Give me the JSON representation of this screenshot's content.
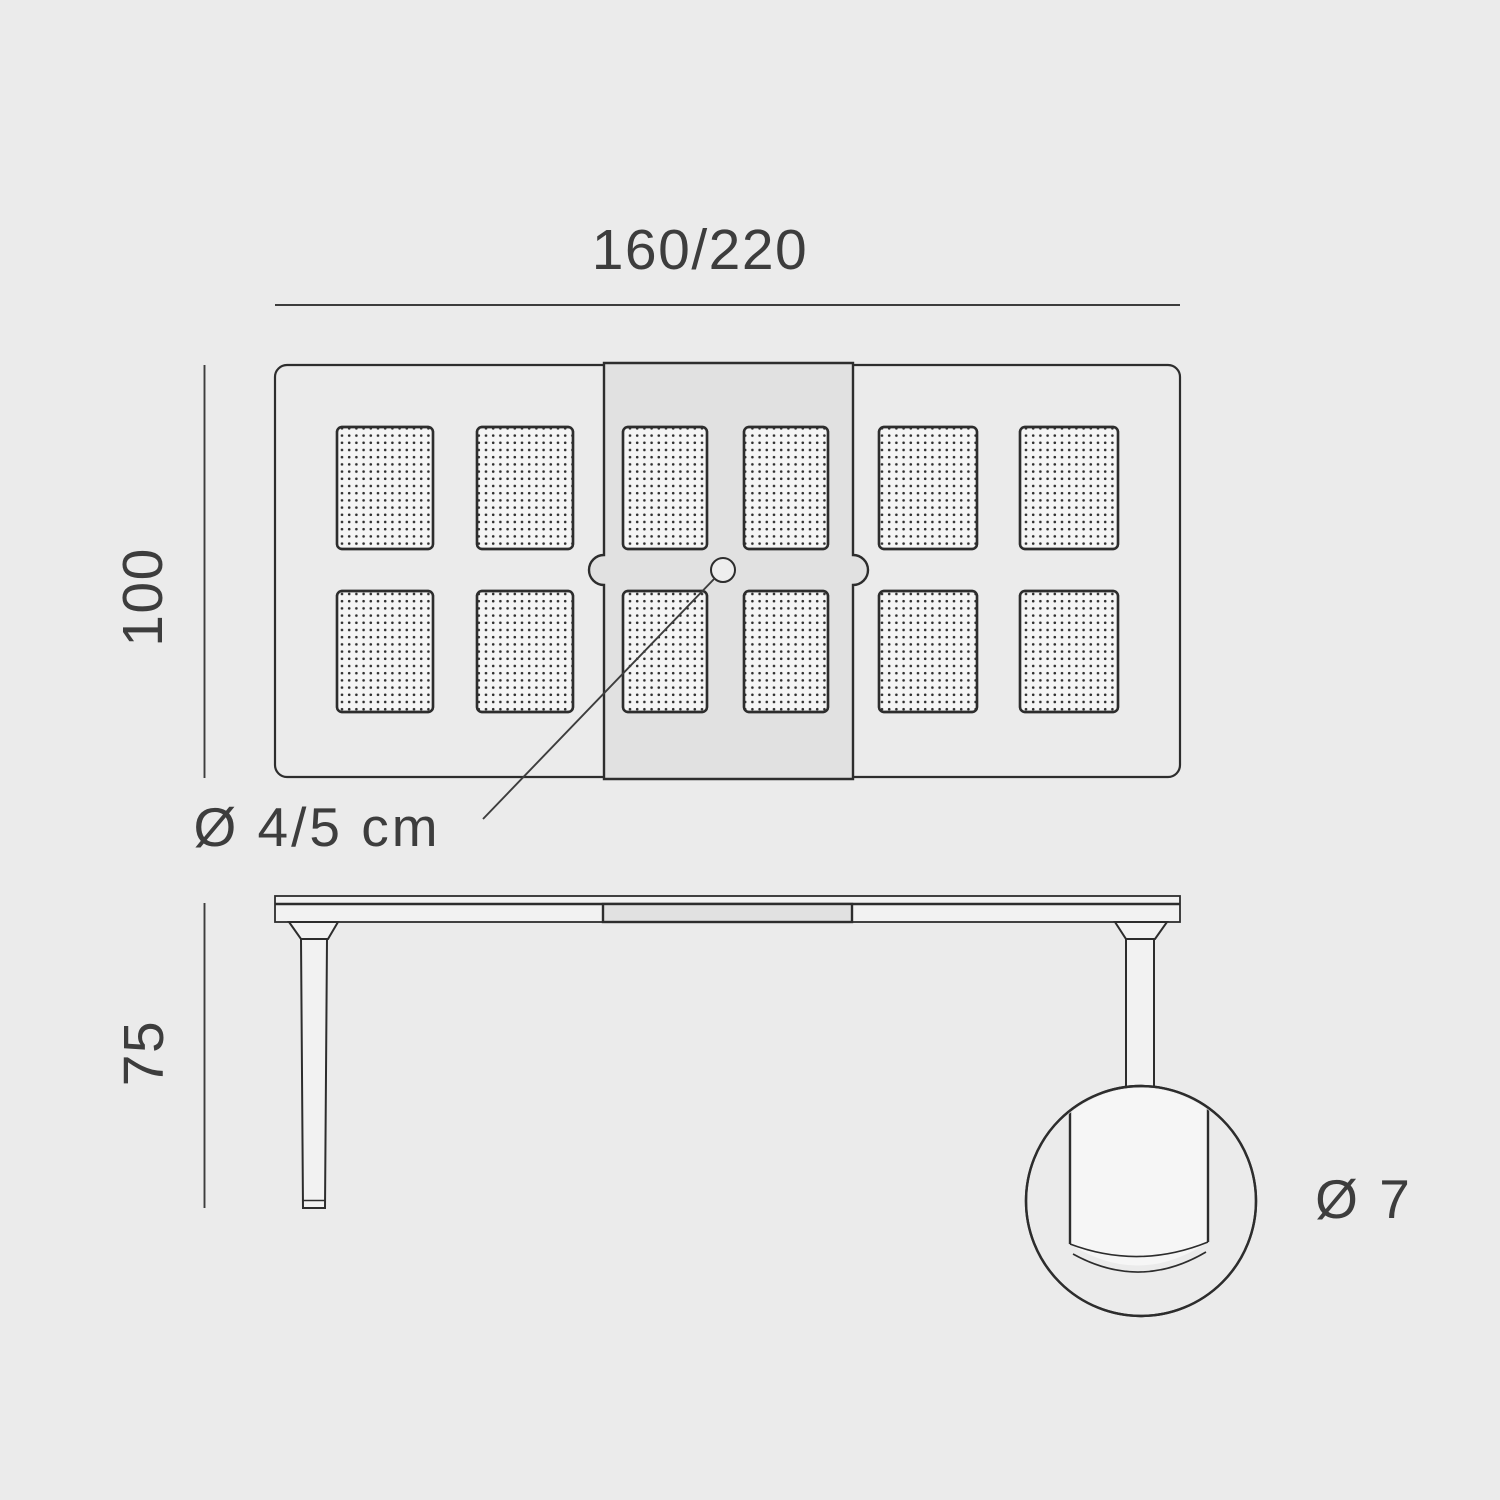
{
  "diagram": {
    "labels": {
      "width_range": "160/220",
      "depth": "100",
      "umbrella_hole": "Ø 4/5 cm",
      "height": "75",
      "leg_diameter": "Ø 7"
    },
    "colors": {
      "background": "#ebebeb",
      "line": "#2d2d2d",
      "text": "#3d3d3d",
      "leaf": "#e1e1e1",
      "panel": "#f5f5f5",
      "surface": "#f2f2f2",
      "dot": "#2f2f2f",
      "hole": "#eeeeee"
    }
  }
}
